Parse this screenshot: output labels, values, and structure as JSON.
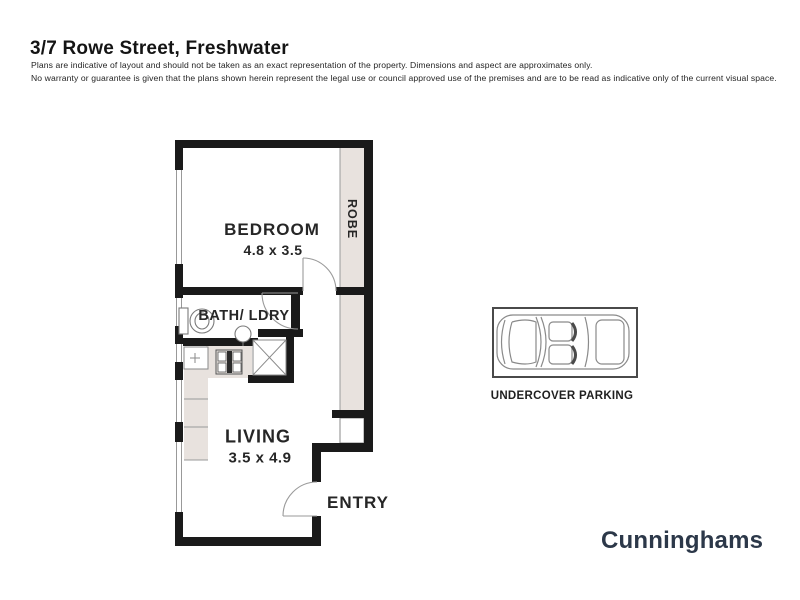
{
  "header": {
    "title": "3/7 Rowe Street, Freshwater",
    "disclaimer_line1": "Plans are indicative of layout and should not be taken as an exact representation of the property. Dimensions and aspect are approximates only.",
    "disclaimer_line2": "No warranty or guarantee is given that the plans shown herein represent the legal use or council approved use of the premises and are to be read as indicative only of the current visual space."
  },
  "floorplan": {
    "rooms": {
      "bedroom": {
        "label": "BEDROOM",
        "dims": "4.8 x 3.5"
      },
      "bath_laundry": {
        "label": "BATH/ LDRY"
      },
      "living": {
        "label": "LIVING",
        "dims": "3.5 x 4.9"
      },
      "entry": {
        "label": "ENTRY"
      },
      "robe": {
        "label": "ROBE"
      }
    },
    "icons": [
      "toilet-icon",
      "basin-icon",
      "cooktop-icon",
      "kitchen-sink-icon",
      "linen-cupboard-icon",
      "door-swing-icon"
    ]
  },
  "parking": {
    "label": "UNDERCOVER PARKING",
    "icon": "car-top-view-icon"
  },
  "branding": {
    "logo": "Cunninghams"
  },
  "colors": {
    "wall": "#1a1a1a",
    "shading": "#e8e2de",
    "thin_line": "#999999",
    "fixture_line": "#7a7a7a",
    "label_text": "#262626",
    "logo_color": "#2c3849",
    "background": "#ffffff"
  }
}
